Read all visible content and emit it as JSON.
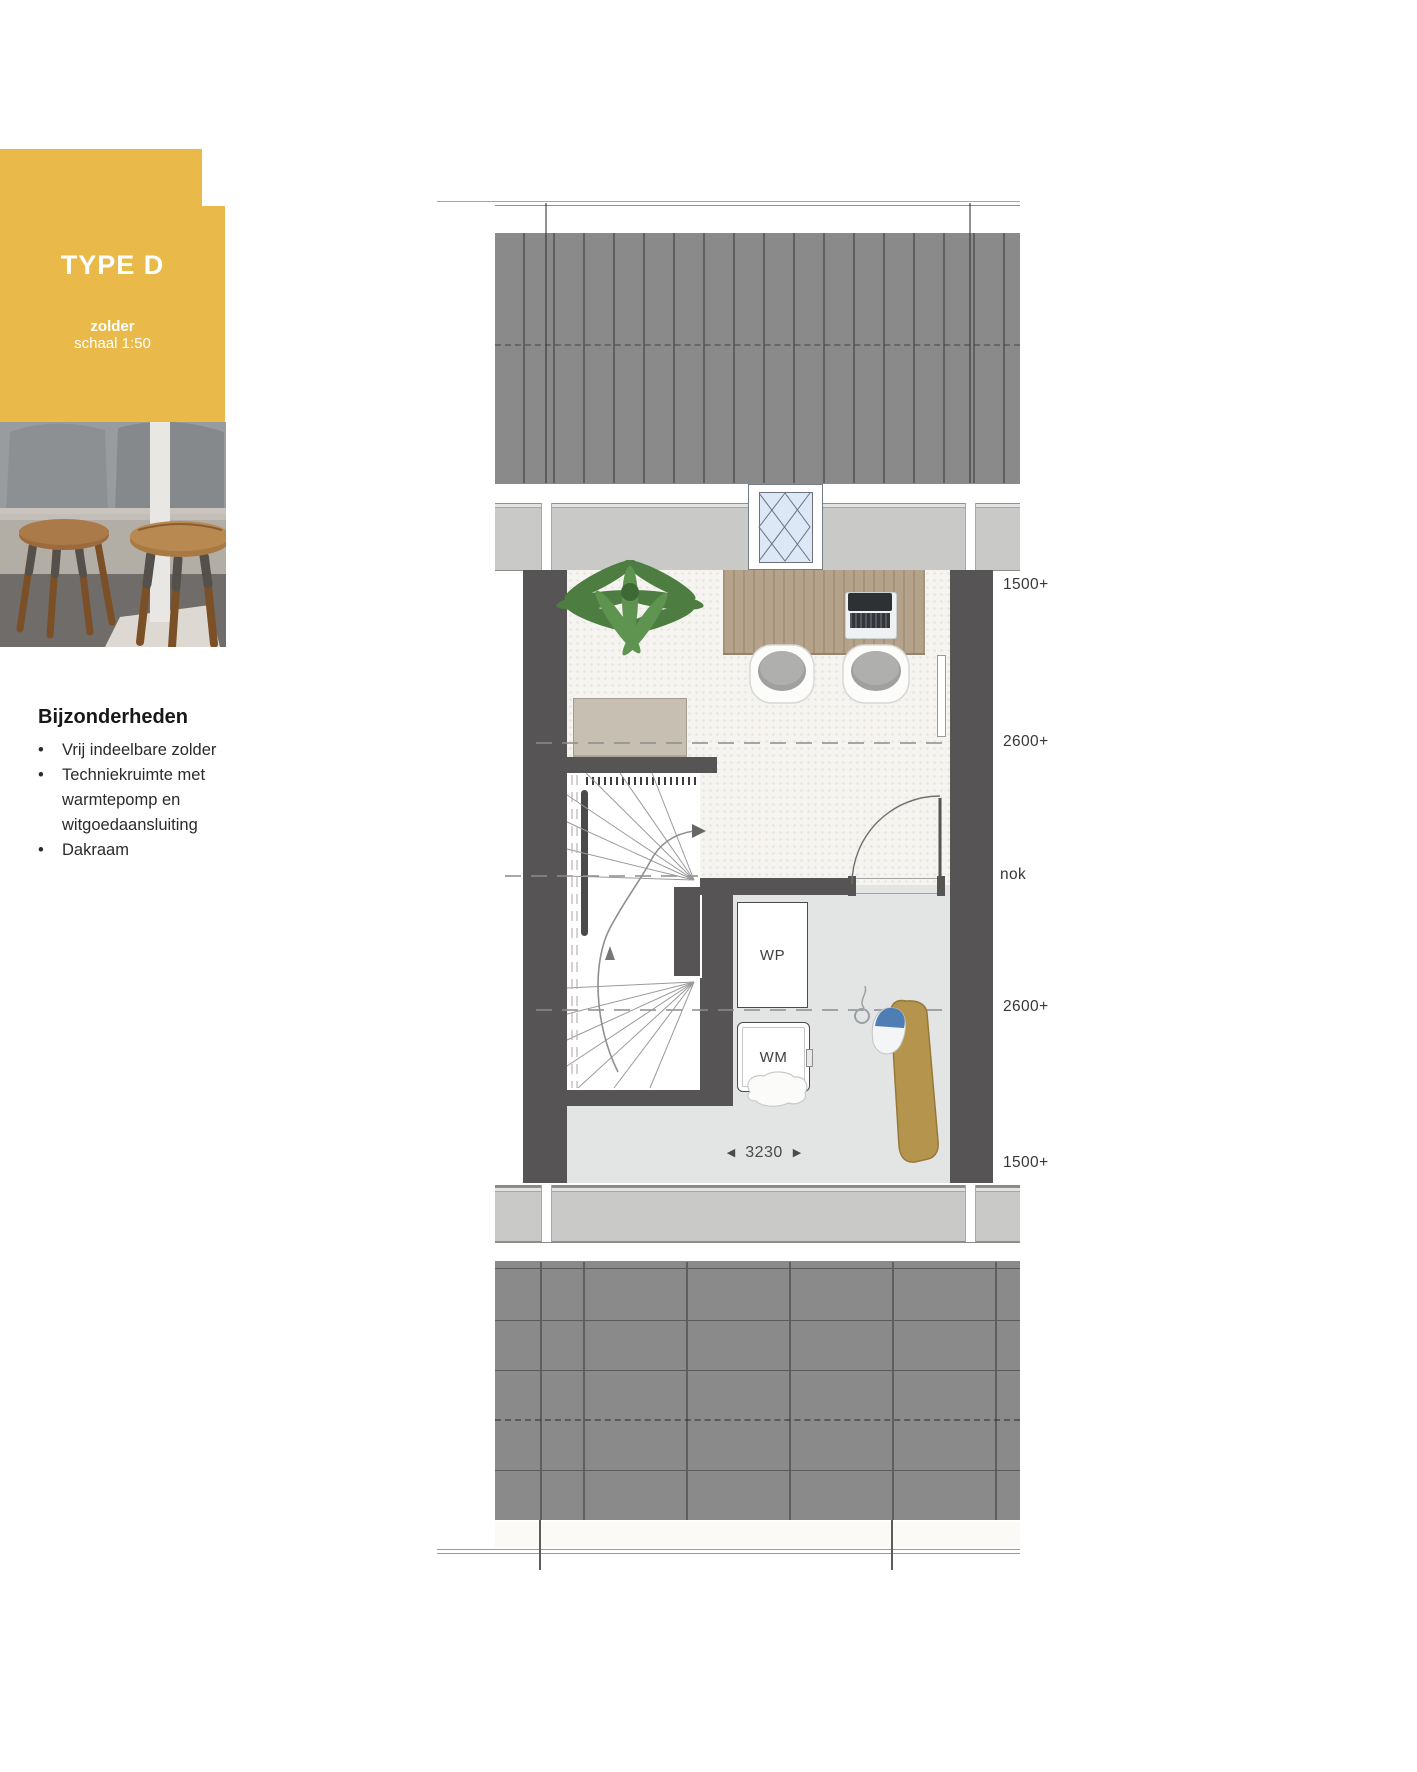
{
  "sidebar": {
    "badge": {
      "title": "TYPE D",
      "subtitle_bold": "zolder",
      "subtitle": "schaal 1:50"
    },
    "details": {
      "heading": "Bijzonderheden",
      "bullet": "•",
      "items": [
        "Vrij indeelbare zolder",
        "Techniekruimte met warmtepomp en witgoedaansluiting",
        "Dakraam"
      ]
    }
  },
  "plan": {
    "height_labels": [
      {
        "text": "1500+"
      },
      {
        "text": "2600+"
      },
      {
        "text": "nok"
      },
      {
        "text": "2600+"
      },
      {
        "text": "1500+"
      }
    ],
    "rooms": {
      "wp": "WP",
      "wm": "WM"
    },
    "dimension": {
      "value": "3230",
      "arrow_left": "◀",
      "arrow_right": "▶"
    }
  },
  "colors": {
    "accent_yellow": "#e9b949",
    "wall_dark": "#565454",
    "roof_gray": "#8a8a8a",
    "eaves_gray": "#c9c9c8",
    "carpet": "#f6f4f0",
    "tech_floor": "#e3e5e5",
    "desk_wood": "#b4a38a",
    "ironing_board": "#b5954d",
    "window_glass": "#dce8f6"
  }
}
